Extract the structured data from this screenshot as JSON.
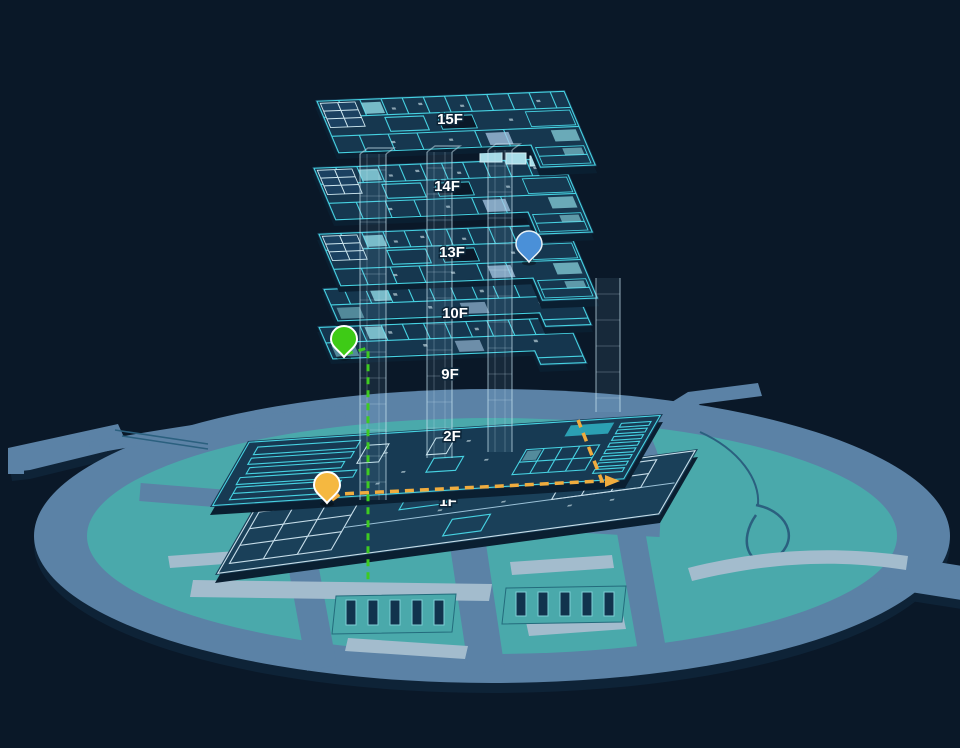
{
  "scene": {
    "title": "3D building floor map",
    "floors": [
      {
        "label": "15F"
      },
      {
        "label": "14F"
      },
      {
        "label": "13F"
      },
      {
        "label": "10F"
      },
      {
        "label": "9F"
      },
      {
        "label": "2F"
      },
      {
        "label": "1F"
      }
    ],
    "pins": [
      {
        "name": "blue-pin",
        "floor": "13F",
        "color": "#4a90d8"
      },
      {
        "name": "green-pin",
        "floor": "9F",
        "color": "#3ecb16"
      },
      {
        "name": "orange-pin",
        "floor": "2F",
        "color": "#f5b840"
      }
    ],
    "routes": [
      {
        "name": "vertical-elevator-route",
        "style": "dashed",
        "color": "#3ecb21"
      },
      {
        "name": "floor-walking-route",
        "style": "dashed",
        "color": "#f0ac3e"
      }
    ],
    "colors": {
      "background": "#0a1828",
      "slab_fill": "#16374f",
      "plan_line": "#46d2e2",
      "island_road": "#5b82a6",
      "island_ground": "#4aa9ab",
      "light_strip": "#a3bccd",
      "label_text": "#ffffff"
    }
  }
}
